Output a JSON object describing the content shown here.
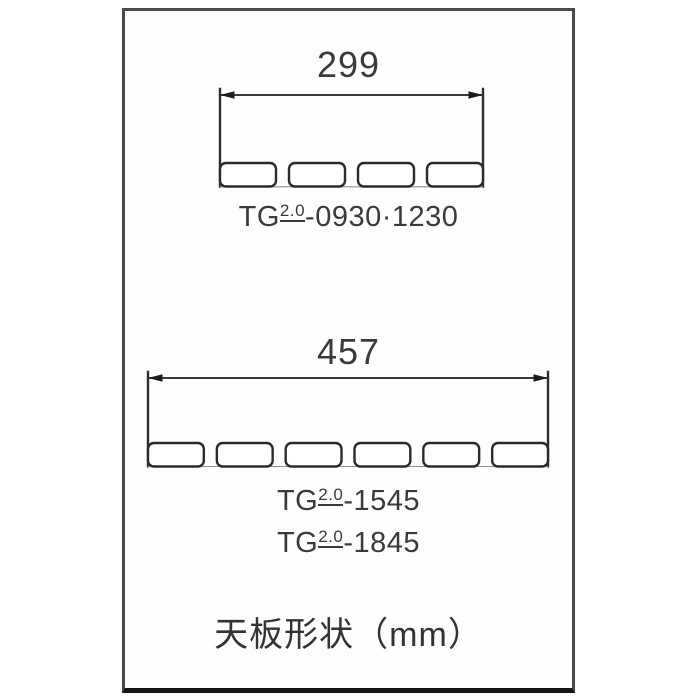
{
  "title": "天板形状（mm）",
  "colors": {
    "line": "#2e2e2e",
    "text": "#3a3a3a",
    "frame_border": "#4a4a4a",
    "frame_bottom_border": "#161616",
    "background": "#ffffff"
  },
  "top_shape": {
    "dimension_mm": "299",
    "tab_count": 4,
    "model_label": {
      "prefix": "TG",
      "sup": "2.0",
      "suffix": "-0930·1230"
    }
  },
  "bottom_shape": {
    "dimension_mm": "457",
    "tab_count": 6,
    "model_labels": [
      {
        "prefix": "TG",
        "sup": "2.0",
        "suffix": "-1545"
      },
      {
        "prefix": "TG",
        "sup": "2.0",
        "suffix": "-1845"
      }
    ]
  }
}
